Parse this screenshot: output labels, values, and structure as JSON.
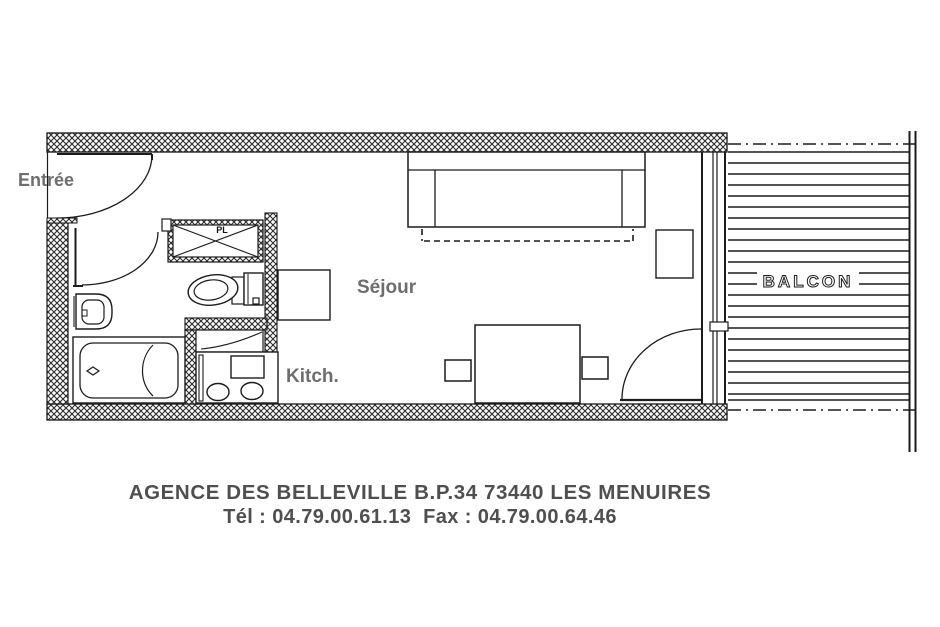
{
  "plan": {
    "rooms": {
      "entrance_label": "Entrée",
      "living_label": "Séjour",
      "kitchen_label": "Kitch.",
      "balcony_label": "BALCON",
      "closet_label": "PL"
    },
    "footer": {
      "line1": "AGENCE DES BELLEVILLE B.P.34 73440 LES MENUIRES",
      "line2": "Tél : 04.79.00.61.13  Fax : 04.79.00.64.46"
    },
    "colors": {
      "ink": "#1c1c1c",
      "label_gray": "#6e6e6e",
      "footer_gray": "#4f4f4f",
      "background": "#ffffff"
    }
  }
}
